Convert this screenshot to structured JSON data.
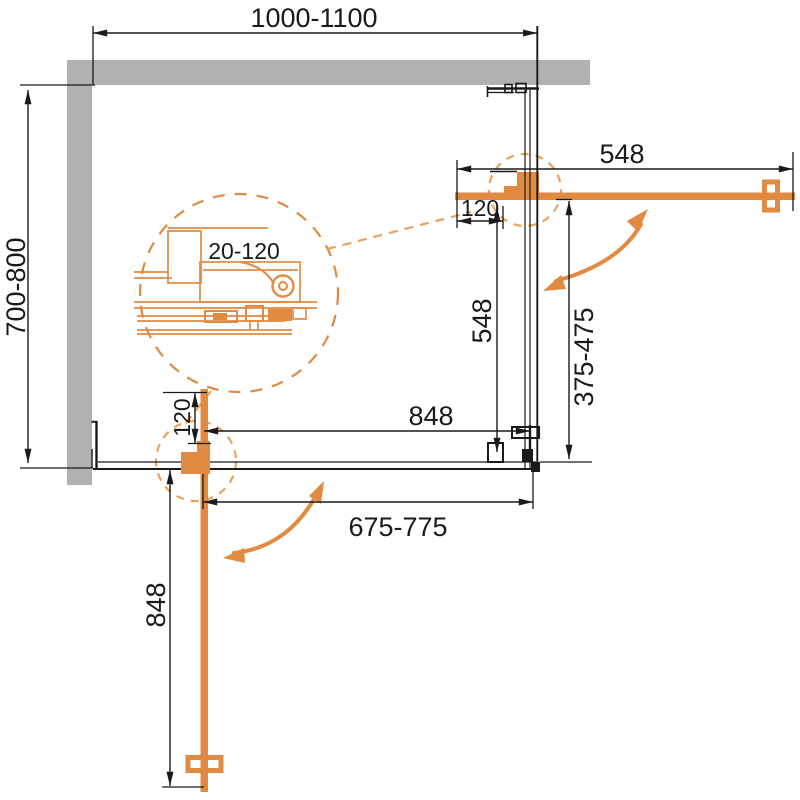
{
  "diagram": {
    "name": "corner-shower-enclosure-plan-view",
    "colors": {
      "wall_gray": "#B1B1B1",
      "line_black": "#1A1A1A",
      "orange": "#E18A42",
      "orange_light": "#EDA15B"
    },
    "labels": {
      "overall_width": "1000-1100",
      "overall_depth": "700-800",
      "top_door_width": "548",
      "top_door_offset": "120",
      "side_panel_length": "548",
      "opening_depth": "375-475",
      "bottom_panel_width": "848",
      "opening_width": "675-775",
      "bottom_door_offset": "120",
      "bottom_door_length": "848",
      "adjustment_range": "20-120"
    }
  }
}
